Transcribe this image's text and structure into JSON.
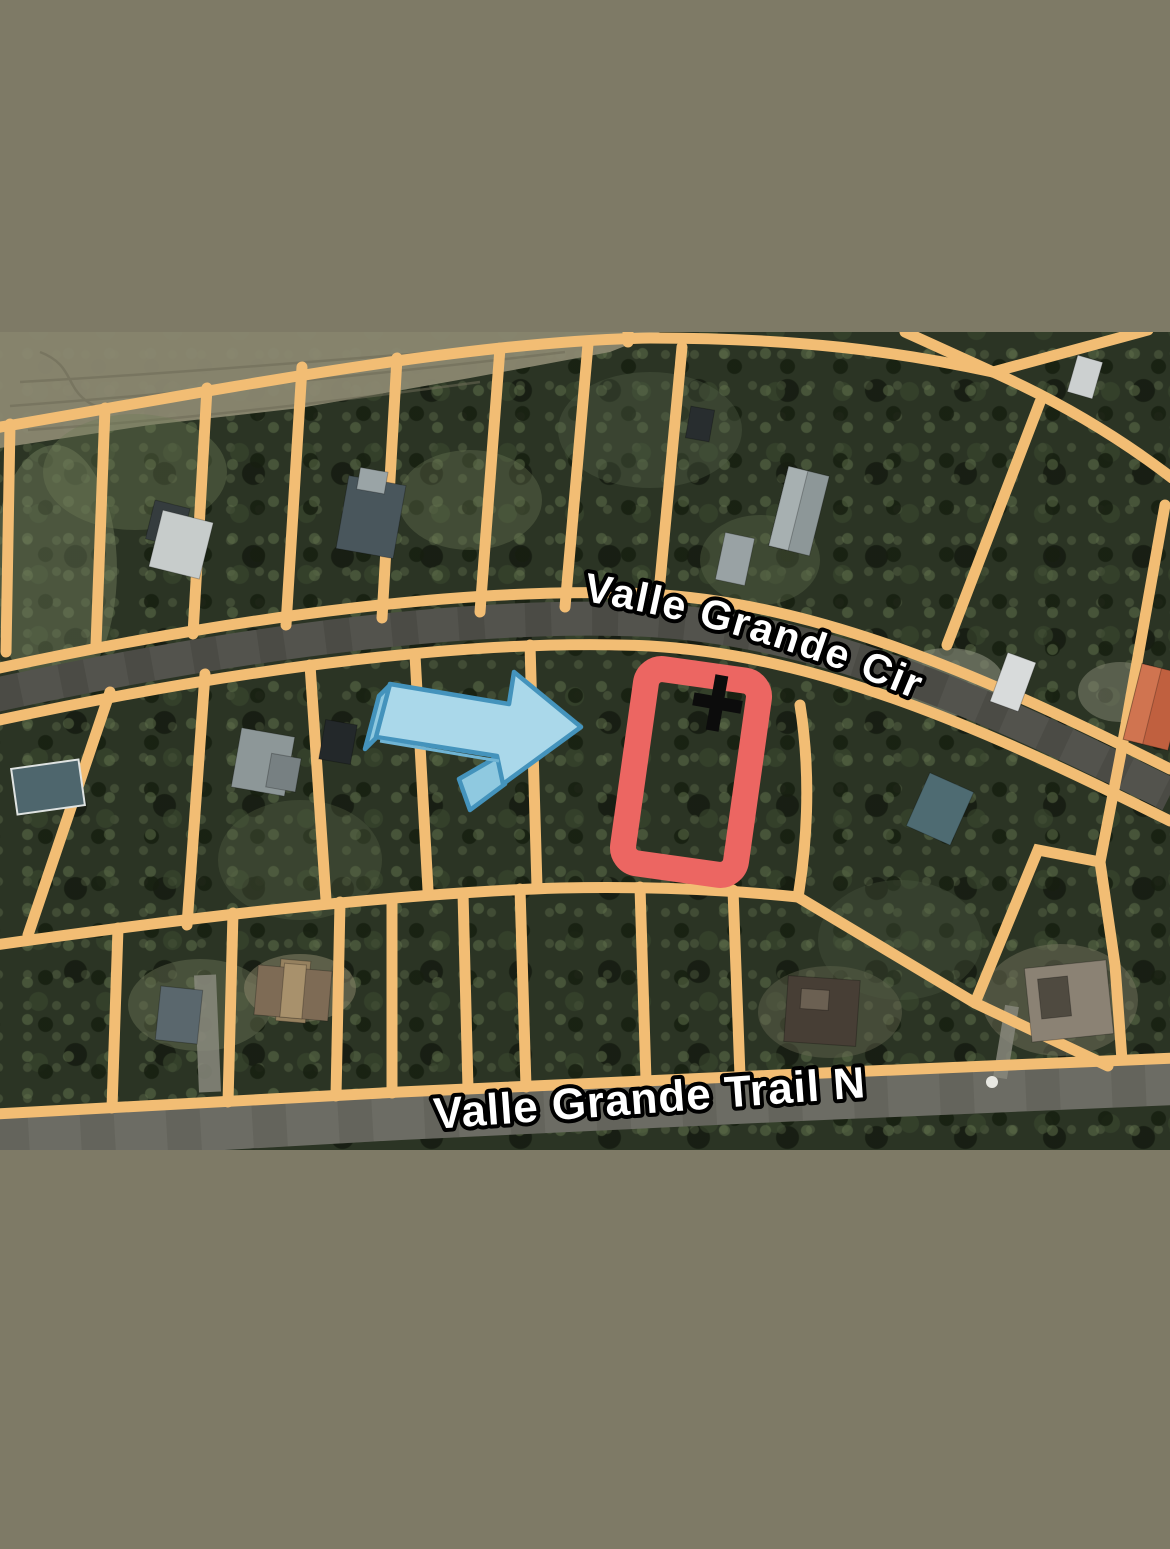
{
  "map": {
    "road_labels": {
      "circle": "Valle Grande Cir",
      "trail": "Valle Grande Trail N"
    },
    "markers": {
      "parcel_highlight": "red-rectangle-outline",
      "pointer": "blue-3d-arrow",
      "cross": "black-cross-marker"
    },
    "colors": {
      "band": "#7e7a66",
      "parcel_line": "#f2bd74",
      "road_circle": "#53534d",
      "road_trail": "#6c6c64",
      "highlight": "#ec6662",
      "cross": "#0c0c0c",
      "arrow_fill": "#aad8ea",
      "arrow_side": "#8fc9e0",
      "arrow_outline": "#4493bc",
      "label_fill": "#ffffff",
      "label_stroke": "#000000"
    }
  }
}
